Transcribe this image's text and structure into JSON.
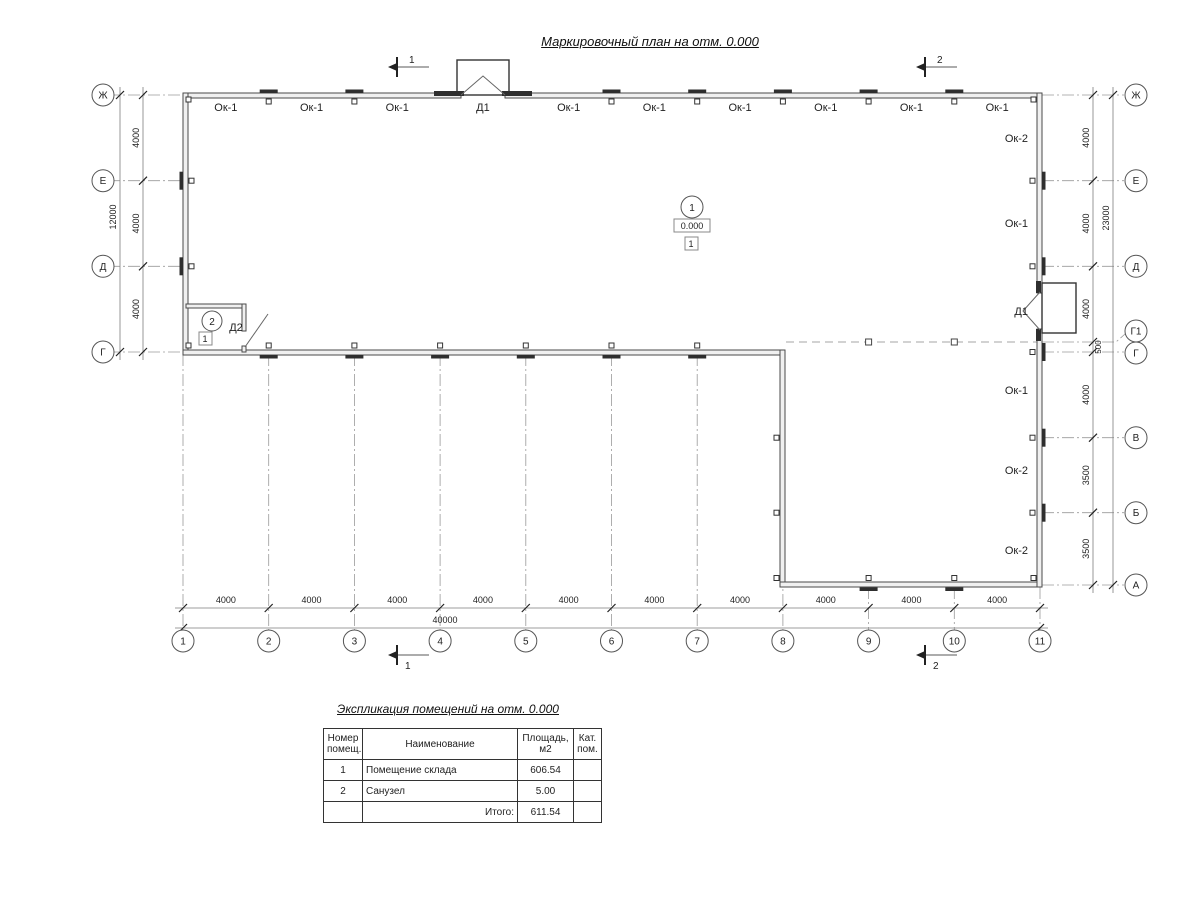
{
  "title": "Маркировочный план на отм. 0.000",
  "section_marks": {
    "s1": "1",
    "s2": "2"
  },
  "axes": {
    "left": [
      "Ж",
      "Е",
      "Д",
      "Г"
    ],
    "right": [
      "Ж",
      "Е",
      "Д",
      "Г1",
      "Г",
      "В",
      "Б",
      "А"
    ],
    "bottom": [
      "1",
      "2",
      "3",
      "4",
      "5",
      "6",
      "7",
      "8",
      "9",
      "10",
      "11"
    ]
  },
  "dimensions": {
    "left_segments": [
      "4000",
      "4000",
      "4000"
    ],
    "left_total": "12000",
    "right_segments": [
      "4000",
      "4000",
      "4000",
      "500",
      "4000",
      "3500",
      "3500"
    ],
    "right_total": "23000",
    "bottom_segments": [
      "4000",
      "4000",
      "4000",
      "4000",
      "4000",
      "4000",
      "4000",
      "4000",
      "4000",
      "4000"
    ],
    "bottom_total": "40000"
  },
  "labels": {
    "top_wall": [
      "Ок-1",
      "Ок-1",
      "Ок-1",
      "Д1",
      "Ок-1",
      "Ок-1",
      "Ок-1",
      "Ок-1",
      "Ок-1",
      "Ок-1"
    ],
    "right_wall": [
      "Ок-2",
      "Ок-1",
      "Д1",
      "Ок-1",
      "Ок-2",
      "Ок-2"
    ],
    "door2": "Д2"
  },
  "room_markers": {
    "room1": {
      "number": "1",
      "elevation": "0.000",
      "category": "1"
    },
    "room2": {
      "number": "2",
      "category": "1"
    }
  },
  "table": {
    "title": "Экспликация помещений на отм. 0.000",
    "headers": [
      "Номер помещ.",
      "Наименование",
      "Площадь, м2",
      "Кат. пом."
    ],
    "rows": [
      {
        "num": "1",
        "name": "Помещение склада",
        "area": "606.54",
        "cat": ""
      },
      {
        "num": "2",
        "name": "Санузел",
        "area": "5.00",
        "cat": ""
      }
    ],
    "total_label": "Итого:",
    "total_value": "611.54"
  }
}
